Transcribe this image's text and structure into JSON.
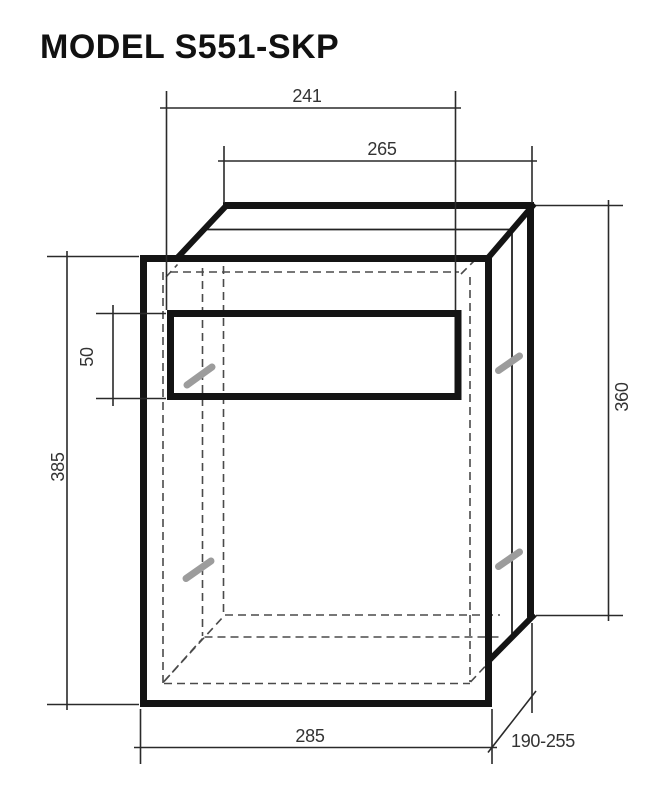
{
  "title": "MODEL S551-SKP",
  "diagram": {
    "type": "technical-dimension-drawing",
    "subject": "recessed box unit with front frame, paper slot opening and adjustable depth body",
    "dimensions": {
      "slot_width": "241",
      "body_width": "265",
      "slot_height": "50",
      "front_frame_height": "385",
      "body_height": "360",
      "front_frame_width": "285",
      "depth_range": "190-255"
    },
    "colors": {
      "line": "#141414",
      "hidden_edge": "#4a4a4a",
      "screw": "#9c9c9c",
      "text": "#333333"
    }
  }
}
